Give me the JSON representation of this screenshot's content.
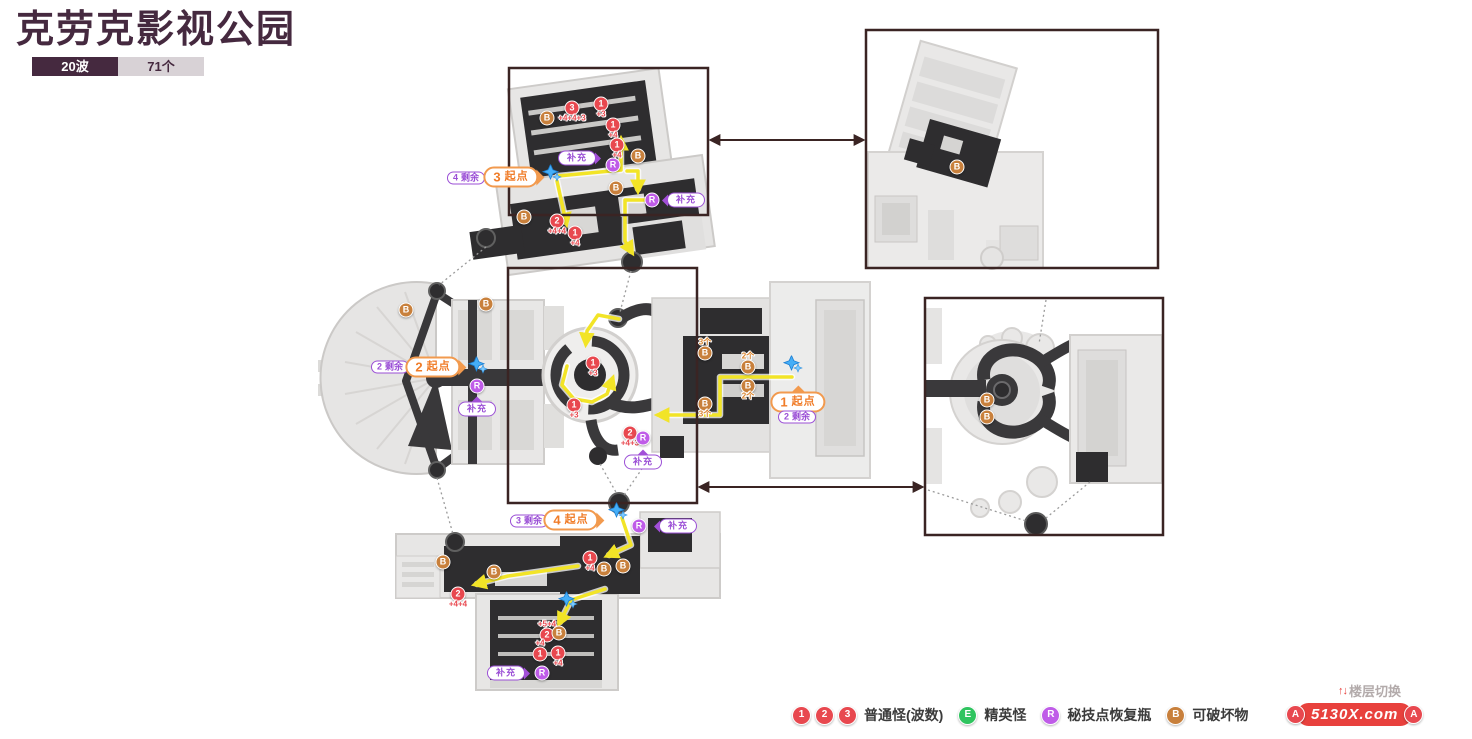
{
  "header": {
    "title": "克劳克影视公园",
    "badge_waves": "20波",
    "badge_count": "71个"
  },
  "legend": {
    "items": [
      {
        "circles": [
          "1",
          "2",
          "3"
        ],
        "color": "#e8484f",
        "label": "普通怪(波数)"
      },
      {
        "circles": [
          "E"
        ],
        "color": "#2fc45f",
        "label": "精英怪"
      },
      {
        "circles": [
          "R"
        ],
        "color": "#bf5ce8",
        "label": "秘技点恢复瓶"
      },
      {
        "circles": [
          "B"
        ],
        "color": "#c8803c",
        "label": "可破坏物"
      }
    ]
  },
  "floor_link": {
    "marker": "A",
    "floor_switch": "楼层切换",
    "site_watermark": "5130X.com"
  },
  "colors": {
    "accent_dark": "#45293f",
    "normal_enemy": "#e8484f",
    "elite_enemy": "#2fc45f",
    "technique_bottle": "#bf5ce8",
    "breakable": "#c8803c",
    "breakable_text": "#d9832c",
    "route": "#f2e427",
    "start_pill": "#f29a4e",
    "purple_pill": "#9b4fd6",
    "panel_border": "#3a2423",
    "dotted": "#9b9b9b",
    "watermark_red": "#e8413d",
    "sparkle_blue": "#45aef7"
  },
  "map": {
    "panels": [
      {
        "x": 509,
        "y": 68,
        "w": 199,
        "h": 147
      },
      {
        "x": 508,
        "y": 268,
        "w": 189,
        "h": 235
      },
      {
        "x": 866,
        "y": 30,
        "w": 292,
        "h": 238
      },
      {
        "x": 925,
        "y": 298,
        "w": 238,
        "h": 237
      }
    ],
    "link_arrows": [
      [
        712,
        140,
        862,
        140
      ],
      [
        701,
        487,
        921,
        487
      ]
    ],
    "dotted": [
      [
        486,
        247,
        439,
        285
      ],
      [
        631,
        271,
        620,
        312
      ],
      [
        600,
        464,
        617,
        494
      ],
      [
        648,
        460,
        624,
        495
      ],
      [
        437,
        478,
        453,
        534
      ],
      [
        1046,
        300,
        1039,
        344
      ],
      [
        1090,
        482,
        1046,
        518
      ],
      [
        928,
        490,
        1026,
        521
      ]
    ],
    "routes": [
      {
        "pts": [
          [
            558,
            176
          ],
          [
            621,
            170
          ],
          [
            621,
            141
          ]
        ]
      },
      {
        "pts": [
          [
            557,
            181
          ],
          [
            566,
            222
          ]
        ]
      },
      {
        "pts": [
          [
            627,
            171
          ],
          [
            638,
            171
          ],
          [
            638,
            189
          ]
        ]
      },
      {
        "pts": [
          [
            650,
            200
          ],
          [
            625,
            200
          ],
          [
            625,
            241
          ],
          [
            631,
            251
          ]
        ]
      },
      {
        "pts": [
          [
            792,
            377
          ],
          [
            720,
            377
          ],
          [
            720,
            415
          ],
          [
            660,
            415
          ]
        ]
      },
      {
        "pts": [
          [
            619,
            319
          ],
          [
            598,
            315
          ],
          [
            587,
            331
          ],
          [
            586,
            342
          ]
        ]
      },
      {
        "pts": [
          [
            567,
            366
          ],
          [
            562,
            385
          ],
          [
            574,
            399
          ],
          [
            592,
            402
          ],
          [
            607,
            394
          ],
          [
            612,
            380
          ]
        ]
      },
      {
        "pts": [
          [
            622,
            518
          ],
          [
            631,
            545
          ],
          [
            609,
            555
          ]
        ]
      },
      {
        "pts": [
          [
            578,
            566
          ],
          [
            508,
            576
          ],
          [
            477,
            584
          ]
        ]
      },
      {
        "pts": [
          [
            605,
            589
          ],
          [
            571,
            600
          ],
          [
            560,
            622
          ]
        ]
      }
    ],
    "markers": [
      {
        "t": "B",
        "x": 547,
        "y": 118
      },
      {
        "t": "3",
        "x": 572,
        "y": 108,
        "sub": "+4+4+3"
      },
      {
        "t": "1",
        "x": 601,
        "y": 104,
        "sub": "+3"
      },
      {
        "t": "1",
        "x": 613,
        "y": 125,
        "sub": "+4"
      },
      {
        "t": "1",
        "x": 617,
        "y": 145,
        "sub": "+4"
      },
      {
        "t": "R",
        "x": 613,
        "y": 165
      },
      {
        "t": "B",
        "x": 638,
        "y": 156
      },
      {
        "t": "B",
        "x": 616,
        "y": 188
      },
      {
        "t": "R",
        "x": 652,
        "y": 200
      },
      {
        "t": "B",
        "x": 524,
        "y": 217
      },
      {
        "t": "2",
        "x": 557,
        "y": 221,
        "sub": "+4+4"
      },
      {
        "t": "1",
        "x": 575,
        "y": 233,
        "sub": "+4"
      },
      {
        "t": "1",
        "x": 593,
        "y": 363,
        "sub": "+3"
      },
      {
        "t": "1",
        "x": 574,
        "y": 405,
        "sub": "+3"
      },
      {
        "t": "2",
        "x": 630,
        "y": 433,
        "sub": "+4+3"
      },
      {
        "t": "R",
        "x": 643,
        "y": 438
      },
      {
        "t": "B",
        "x": 705,
        "y": 353,
        "sub": "3个",
        "subPos": "above"
      },
      {
        "t": "B",
        "x": 748,
        "y": 367,
        "sub": "2个",
        "subPos": "above"
      },
      {
        "t": "B",
        "x": 748,
        "y": 386,
        "sub": "2个"
      },
      {
        "t": "B",
        "x": 705,
        "y": 404,
        "sub": "3个"
      },
      {
        "t": "B",
        "x": 406,
        "y": 310
      },
      {
        "t": "B",
        "x": 486,
        "y": 304
      },
      {
        "t": "R",
        "x": 477,
        "y": 386
      },
      {
        "t": "R",
        "x": 639,
        "y": 526
      },
      {
        "t": "1",
        "x": 590,
        "y": 558,
        "sub": "+4"
      },
      {
        "t": "B",
        "x": 604,
        "y": 569
      },
      {
        "t": "B",
        "x": 623,
        "y": 566
      },
      {
        "t": "B",
        "x": 494,
        "y": 572
      },
      {
        "t": "B",
        "x": 443,
        "y": 562
      },
      {
        "t": "2",
        "x": 458,
        "y": 594,
        "sub": "+4+4"
      },
      {
        "t": "2",
        "x": 547,
        "y": 635,
        "sub": "+5+4",
        "subPos": "above"
      },
      {
        "t": "B",
        "x": 559,
        "y": 633
      },
      {
        "t": "1",
        "x": 540,
        "y": 654,
        "sub": "+4",
        "subPos": "above"
      },
      {
        "t": "1",
        "x": 558,
        "y": 653,
        "sub": "+4"
      },
      {
        "t": "R",
        "x": 542,
        "y": 673
      },
      {
        "t": "B",
        "x": 957,
        "y": 167
      },
      {
        "t": "B",
        "x": 987,
        "y": 400
      },
      {
        "t": "B",
        "x": 987,
        "y": 417
      }
    ],
    "pills": [
      {
        "k": "remain",
        "num": "4",
        "label": "剩余",
        "x": 466,
        "y": 178
      },
      {
        "k": "start",
        "num": "3",
        "label": "起点",
        "x": 511,
        "y": 177,
        "arrow": "right"
      },
      {
        "k": "refill",
        "label": "补充",
        "x": 577,
        "y": 158,
        "arrow": "right"
      },
      {
        "k": "refill",
        "label": "补充",
        "x": 686,
        "y": 200,
        "arrow": "left"
      },
      {
        "k": "remain",
        "num": "2",
        "label": "剩余",
        "x": 390,
        "y": 367
      },
      {
        "k": "start",
        "num": "2",
        "label": "起点",
        "x": 433,
        "y": 367,
        "arrow": "right"
      },
      {
        "k": "refill",
        "label": "补充",
        "x": 477,
        "y": 409,
        "arrow": "up"
      },
      {
        "k": "start",
        "num": "1",
        "label": "起点",
        "x": 798,
        "y": 402,
        "arrow": "up"
      },
      {
        "k": "remain",
        "num": "2",
        "label": "剩余",
        "x": 797,
        "y": 417
      },
      {
        "k": "refill",
        "label": "补充",
        "x": 643,
        "y": 462,
        "arrow": "up"
      },
      {
        "k": "remain",
        "num": "3",
        "label": "剩余",
        "x": 529,
        "y": 521
      },
      {
        "k": "start",
        "num": "4",
        "label": "起点",
        "x": 571,
        "y": 520,
        "arrow": "right"
      },
      {
        "k": "refill",
        "label": "补充",
        "x": 678,
        "y": 526,
        "arrow": "left"
      },
      {
        "k": "refill",
        "label": "补充",
        "x": 506,
        "y": 673,
        "arrow": "right"
      }
    ],
    "sparkles": [
      [
        552,
        176
      ],
      [
        478,
        368
      ],
      [
        793,
        367
      ],
      [
        618,
        514
      ],
      [
        568,
        603
      ]
    ]
  }
}
